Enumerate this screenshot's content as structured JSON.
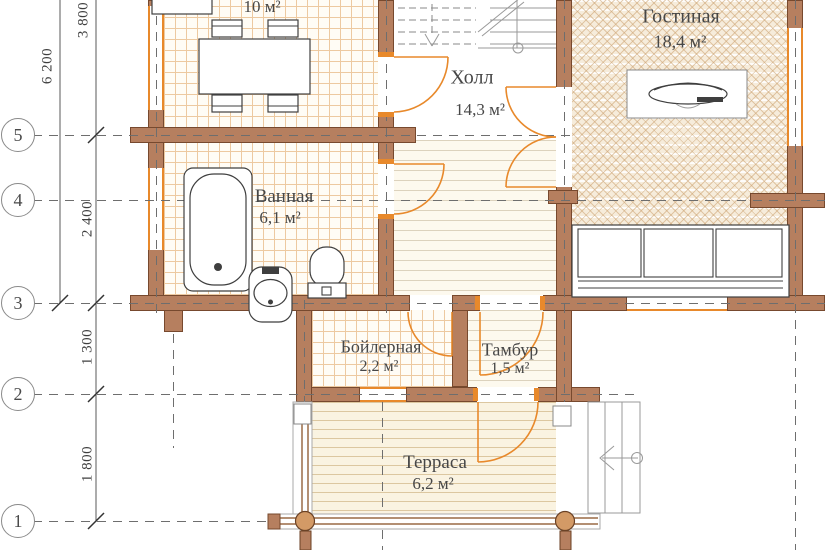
{
  "rooms": {
    "kitchen": {
      "area": "10 м²"
    },
    "hall": {
      "name": "Холл",
      "area": "14,3 м²"
    },
    "living": {
      "name": "Гостиная",
      "area": "18,4 м²"
    },
    "bathroom": {
      "name": "Ванная",
      "area": "6,1 м²"
    },
    "boiler": {
      "name": "Бойлерная",
      "area": "2,2 м²"
    },
    "vestibule": {
      "name": "Тамбур",
      "area": "1,5 м²"
    },
    "terrace": {
      "name": "Терраса",
      "area": "6,2 м²"
    }
  },
  "dimensions": {
    "overall": "6 200",
    "upper": "3 800",
    "middle": "2 400",
    "lower": "1 300",
    "bottom": "1 800"
  },
  "axes": {
    "r5": "5",
    "r4": "4",
    "r3": "3",
    "r2": "2",
    "r1": "1"
  },
  "colors": {
    "wall": "#b67f5f",
    "wall_edge": "#77492e",
    "accent": "#e8892b",
    "tile": "#edc9a0",
    "plank": "#dcd2bd",
    "ink": "#474747"
  }
}
